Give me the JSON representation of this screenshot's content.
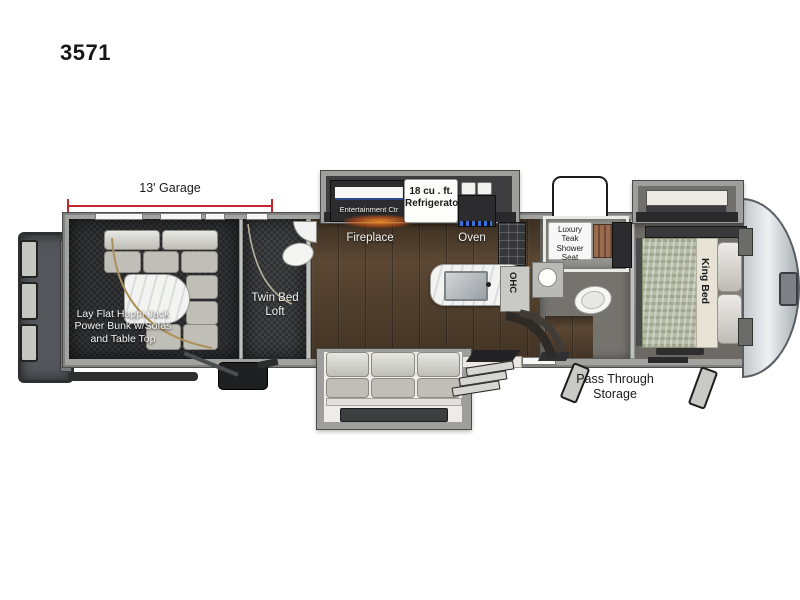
{
  "model_number": "3571",
  "dimensions": {
    "garage": "13' Garage"
  },
  "rooms": {
    "garage": {
      "label": "Lay Flat Happi-Jack\nPower Bunk w/Sofas\nand Table Top"
    },
    "loft": {
      "label": "Twin Bed\nLoft"
    },
    "living": {
      "entertainment": "Entertainment Ctr",
      "fireplace": "Fireplace"
    },
    "kitchen": {
      "refrigerator": "18 cu . ft.\nRefrigerator",
      "oven": "Oven",
      "overhead_cabinet": "OHC"
    },
    "bathroom": {
      "shower_seat": "Luxury\nTeak\nShower Seat"
    },
    "bedroom": {
      "bed": "King Bed"
    },
    "storage": {
      "pass_through": "Pass Through\nStorage"
    }
  },
  "colors": {
    "dimension_line": "#c1272d",
    "wood_floor": "#5b4733",
    "garage_floor": "#2d2f31",
    "sofa": "#c9c9c1",
    "bed": "#b7bda9",
    "fireplace_glow": "#e07b2a"
  }
}
